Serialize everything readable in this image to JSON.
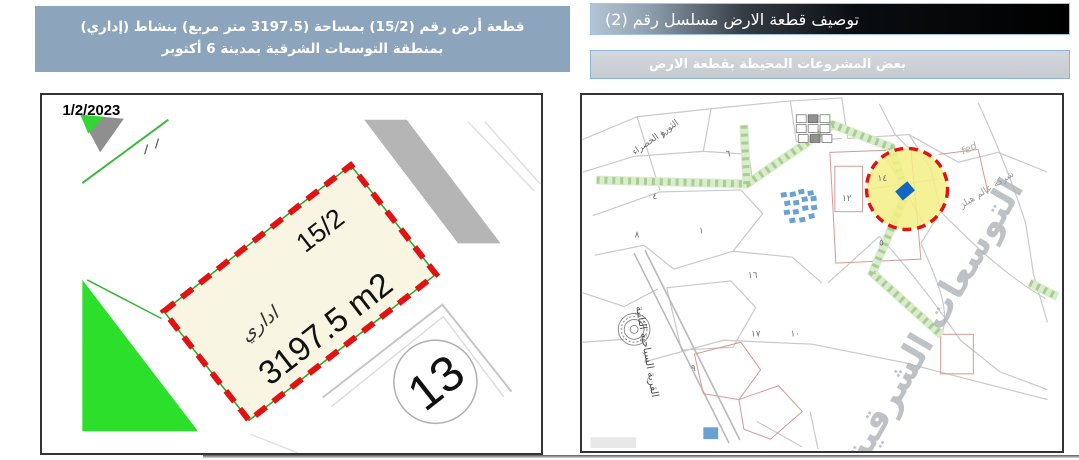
{
  "header_left": {
    "text": "قطعة أرض رقم (15/2) بمساحة (3197.5 متر مربع) بنشاط (إداري) بمنطقة التوسعات الشرقية بمدينة 6 أكتوبر"
  },
  "header_right": {
    "title": "توصيف قطعة الارض مسلسل رقم (2)",
    "subtitle": "بعض المشروعات المحيطة بقطعة الارض"
  },
  "left_map": {
    "date": "1/2/2023",
    "plot_number": "15/2",
    "activity": "اداري",
    "area_label": "3197.5 m2",
    "neighbor_block": "13"
  },
  "right_map": {
    "watermark": "التوسعات الشرقية",
    "road_label": "القرية السياحية الثانية",
    "company_label": "شركة عالم هيلز",
    "district_label": "الثورة الخضراء",
    "script_note": "fed",
    "numerals": [
      "١٤",
      "١٢",
      "٥",
      "٧",
      "٦",
      "٨",
      "٤",
      "٩",
      "١٧",
      "١٦",
      "١٠",
      "١"
    ]
  },
  "colors": {
    "accent-red": "#e11212",
    "plot-fill": "#f8f5e3",
    "highlight-yellow": "#f3ee85",
    "marker-blue": "#1366c2",
    "green-area": "#2bdf2b",
    "header-blue": "#8ca4bc",
    "bar-gray": "#c6cbd0"
  }
}
